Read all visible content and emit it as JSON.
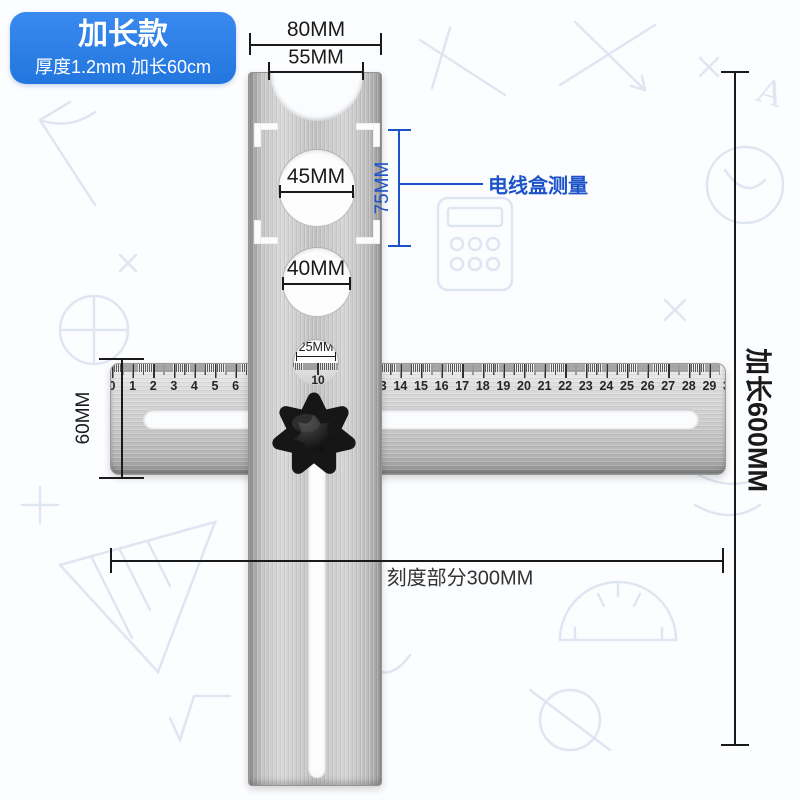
{
  "badge": {
    "title": "加长款",
    "subtitle": "厚度1.2mm 加长60cm"
  },
  "annotations": {
    "top_width": "80MM",
    "notch_width": "55MM",
    "hole_large": "45MM",
    "hole_medium": "40MM",
    "hole_small": "25MM",
    "box_height": "75MM",
    "box_label": "电线盒测量",
    "ruler_height": "60MM",
    "scale_section": "刻度部分300MM",
    "extended_length": "加长600MM"
  },
  "ruler": {
    "unit_numbers": [
      "0",
      "1",
      "2",
      "3",
      "4",
      "5",
      "6",
      "7",
      "8",
      "9",
      "10",
      "11",
      "12",
      "13",
      "14",
      "15",
      "16",
      "17",
      "18",
      "19",
      "20",
      "21",
      "22",
      "23",
      "24",
      "25",
      "26",
      "27",
      "28",
      "29",
      "30"
    ],
    "window_number": "10"
  },
  "colors": {
    "badge_blue": "#2b7de2",
    "annotation_blue": "#1d53c8",
    "dimension_black": "#1a1a1a",
    "metal_light": "#d9d9d9",
    "metal_dark": "#8f8f8f",
    "knob_black": "#161616"
  }
}
